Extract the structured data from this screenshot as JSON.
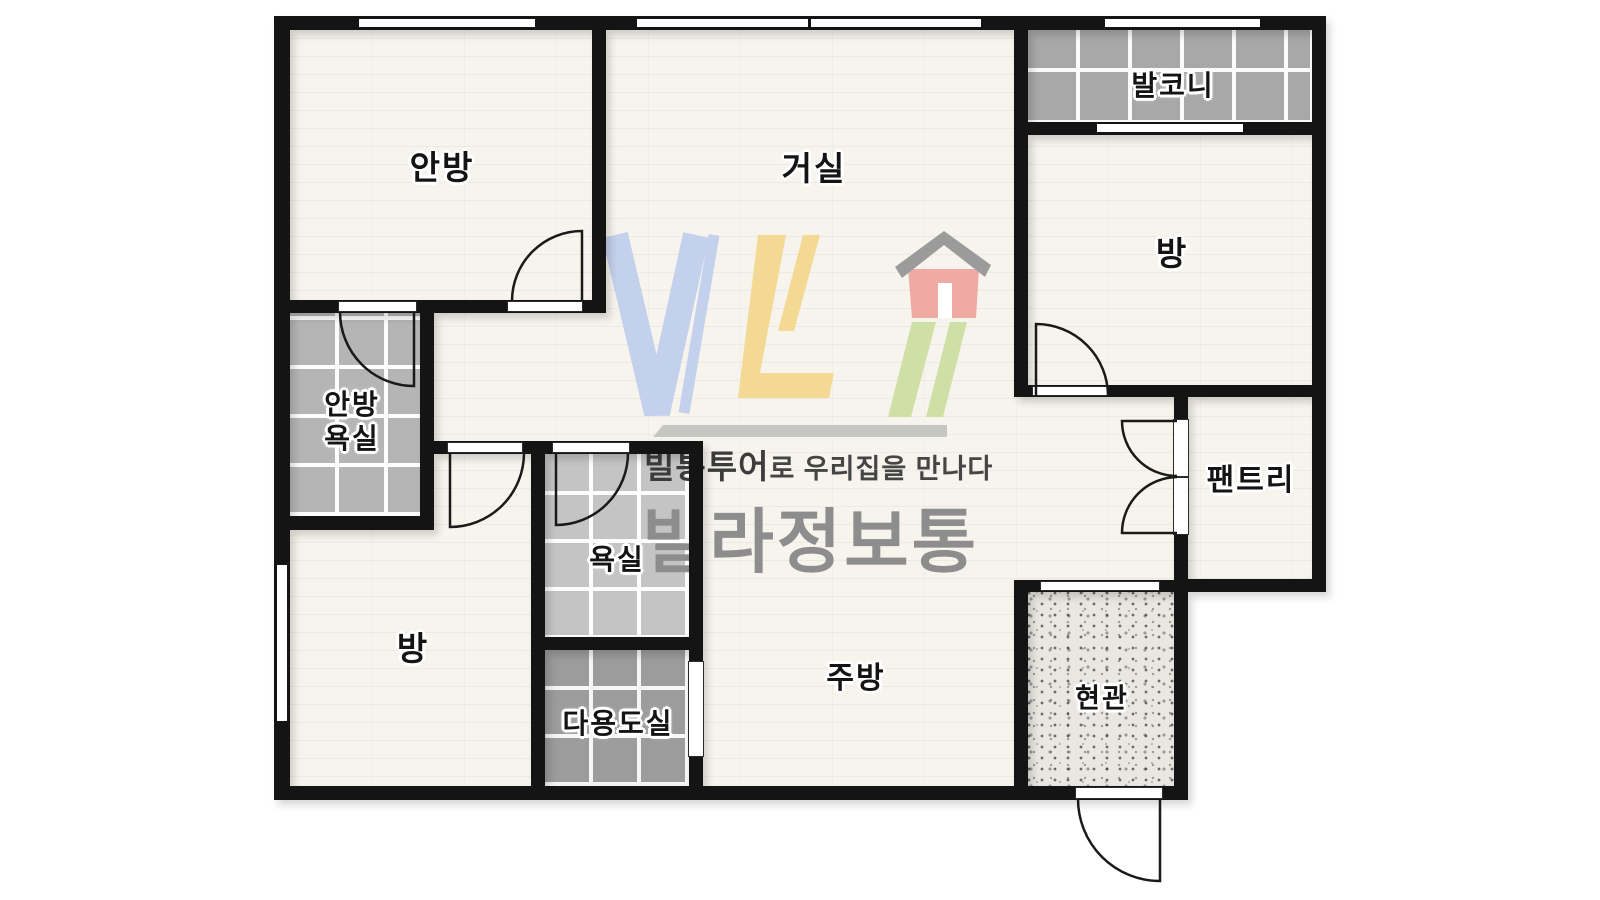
{
  "meta": {
    "type": "apartment-floor-plan"
  },
  "rooms": {
    "anbang": {
      "label": "안방"
    },
    "living": {
      "label": "거실"
    },
    "balcony": {
      "label": "발코니"
    },
    "room_right": {
      "label": "방"
    },
    "anbang_bath": {
      "line1": "안방",
      "line2": "욕실"
    },
    "bath": {
      "label": "욕실"
    },
    "room_left": {
      "label": "방"
    },
    "utility": {
      "label": "다용도실"
    },
    "kitchen": {
      "label": "주방"
    },
    "pantry": {
      "label": "팬트리"
    },
    "entrance": {
      "label": "현관"
    }
  },
  "watermark": {
    "logo_letters": "VL",
    "tagline_bold": "빌통투어",
    "tagline_rest": "로 우리집을 만나다",
    "brand": "빌라정보통"
  },
  "colors": {
    "wall": "#141414",
    "floor_wood": "#f7f4ed",
    "tile_balcony": "#a8a8a8",
    "tile_master_bath": "#b5b5b5",
    "tile_bath": "#c4c4c4",
    "tile_utility": "#9c9c9c",
    "entrance_floor": "#eae7e2",
    "logo_blue": "#c3d1ec",
    "logo_yellow": "#f4d994",
    "logo_red": "#efaaa4",
    "logo_green": "#cfe0a6",
    "logo_roof": "#9b9b9b",
    "brand_gray": "#8d8d8d"
  }
}
